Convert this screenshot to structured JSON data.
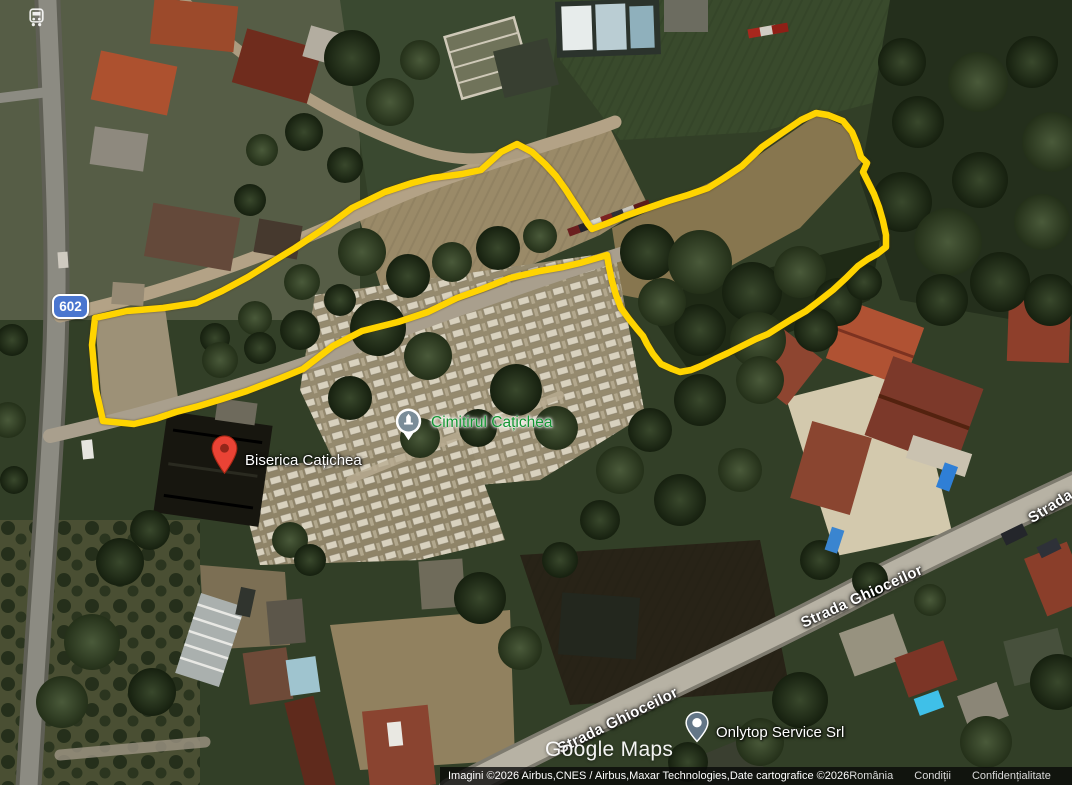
{
  "place_labels": {
    "cemetery": {
      "name": "Cimitirul Cațichea",
      "label_color": "#149632",
      "marker": "cemetery-pin"
    },
    "church": {
      "name": "Biserica Cațichea",
      "marker": "red-pin"
    },
    "business": {
      "name": "Onlytop Service Srl",
      "marker": "place-dot-pin"
    }
  },
  "street_labels": {
    "ghioceilor_upper": "Strada Ghioceilor",
    "ghioceilor_lower": "Strada Ghioceilor",
    "clipped_right": "Strada"
  },
  "route_shield": {
    "number": "602",
    "color": "#4a76cf"
  },
  "transit_stop_icon": "bus-stop",
  "watermark": "Google Maps",
  "attribution": {
    "imagery_credit": "Imagini ©2026 Airbus,CNES / Airbus,Maxar Technologies,Date cartografice ©2026",
    "links": [
      {
        "label": "România"
      },
      {
        "label": "Condiții"
      },
      {
        "label": "Confidențialitate"
      },
      {
        "label": "Trimite fee"
      }
    ]
  },
  "drawn_overlay": {
    "boundary_color": "#ffd400",
    "boundary_path": "M103,421 L96,390 L92,345 L95,318 L127,311 L163,308 L196,303 L222,291 L248,277 L272,262 L295,248 L322,230 L352,208 L385,192 L412,183 L432,178 L462,174 L481,170 L501,152 L517,144 L532,152 L545,164 L556,176 L566,190 L573,201 L581,213 L588,224 L592,229 L608,223 L625,216 L645,209 L668,201 L688,195 L708,188 L724,178 L742,166 L762,147 L782,133 L801,120 L816,113 L828,115 L843,121 L852,132 L857,144 L861,157 L867,163 L863,172 L868,182 L874,194 L879,207 L883,221 L886,235 L886,247 L877,254 L868,259 L858,266 L846,278 L833,290 L819,301 L806,311 L792,319 L779,327 L768,334 L756,339 L742,346 L728,353 L715,359 L701,366 L691,370 L680,372 L672,369 L661,364 L653,354 L647,344 L643,336 L637,329 L629,319 L621,308 L616,295 L612,281 L609,267 L607,255 L597,258 L580,263 L563,267 L540,271 L510,278 L482,289 L457,298 L428,312 L398,322 L362,331 L333,346 L303,369 L281,378 L260,386 L247,391 L222,399 L199,406 L176,412 L155,419 L134,424 Z"
  }
}
